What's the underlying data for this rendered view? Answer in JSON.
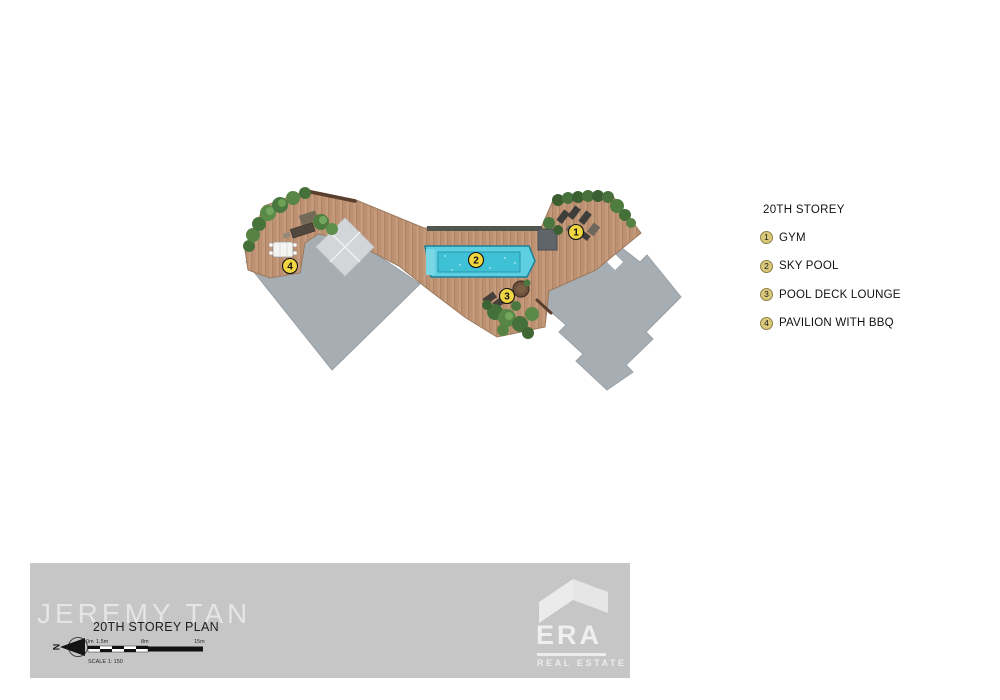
{
  "legend": {
    "title": "20TH STOREY",
    "items": [
      {
        "num": "1",
        "label": "GYM"
      },
      {
        "num": "2",
        "label": "SKY POOL"
      },
      {
        "num": "3",
        "label": "POOL DECK LOUNGE"
      },
      {
        "num": "4",
        "label": "PAVILION WITH BBQ"
      }
    ]
  },
  "plan": {
    "markers": [
      {
        "num": "1",
        "feature": "gym"
      },
      {
        "num": "2",
        "feature": "sky-pool"
      },
      {
        "num": "3",
        "feature": "pool-deck-lounge"
      },
      {
        "num": "4",
        "feature": "pavilion-with-bbq"
      }
    ]
  },
  "footer": {
    "watermark": "JEREMY TAN",
    "plan_title": "20TH STOREY PLAN",
    "north_label": "N",
    "scale": {
      "zero": "0m",
      "first": "1.5m",
      "mid": "8m",
      "end": "15m",
      "caption": "SCALE 1: 150"
    },
    "logo": {
      "name": "ERA",
      "subtitle": "REAL ESTATE"
    }
  },
  "colors": {
    "marker_yellow": "#F0D640",
    "legend_chip": "#D9C87A",
    "pool_water": "#5DCFE0",
    "deck_wood": "#C49A7C",
    "roof_gray": "#A6ADB3",
    "footer_band": "#C6C6C6"
  }
}
